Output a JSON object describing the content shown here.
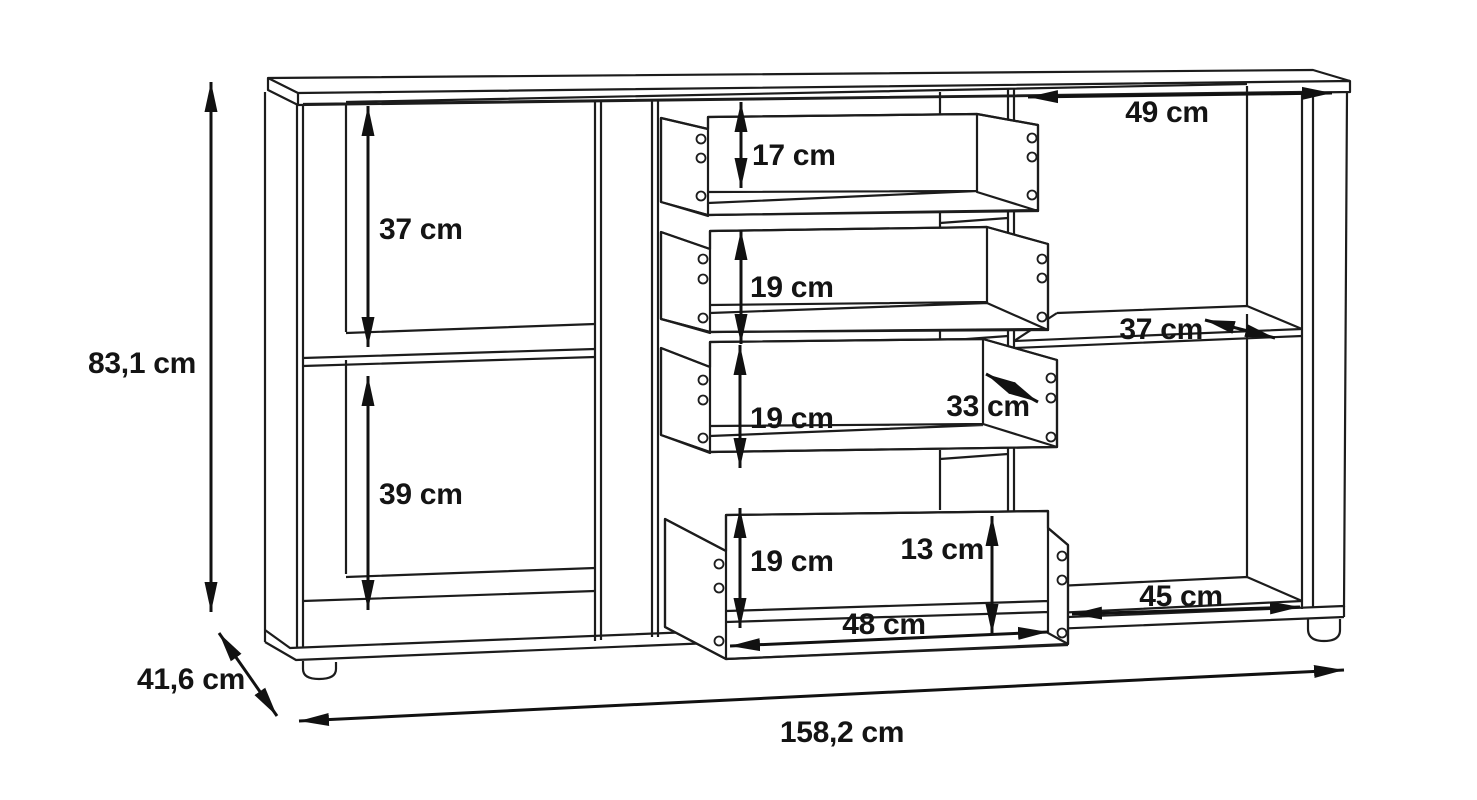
{
  "diagram": {
    "type": "furniture-dimension-line-drawing",
    "subject": "sideboard with open compartments and four pulled-out drawers",
    "unit": "cm",
    "colors": {
      "background": "#ffffff",
      "line": "#1c1c1c",
      "text": "#141414"
    }
  },
  "labels": {
    "overall_height": "83,1 cm",
    "overall_depth": "41,6 cm",
    "overall_width": "158,2 cm",
    "left_upper_compartment_height": "37 cm",
    "left_lower_compartment_height": "39 cm",
    "top_drawer_height": "17 cm",
    "second_drawer_height": "19 cm",
    "third_drawer_height": "19 cm",
    "bottom_drawer_height": "19 cm",
    "right_upper_compartment_width": "49 cm",
    "right_shelf_depth": "37 cm",
    "drawer_depth": "33 cm",
    "drawer_side_height": "13 cm",
    "right_lower_compartment_width": "45 cm",
    "drawer_inner_width": "48 cm"
  }
}
